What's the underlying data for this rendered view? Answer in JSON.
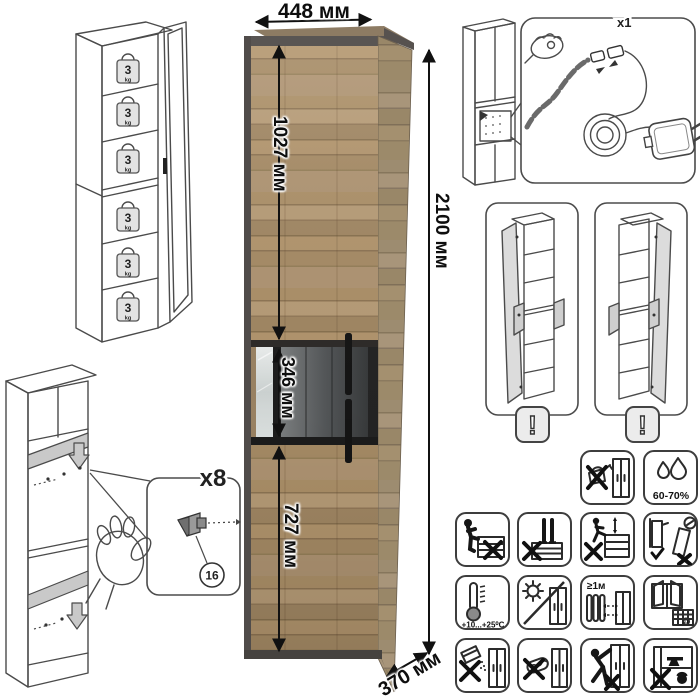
{
  "product": {
    "width_label": "448 мм",
    "height_label": "2100 мм",
    "depth_label": "370 мм",
    "upper_section_label": "1027 мм",
    "display_section_label": "346 мм",
    "lower_section_label": "727 мм"
  },
  "shelf_load": {
    "value": "3",
    "unit": "kg"
  },
  "assembly": {
    "shelf_pin_count": "x8",
    "shelf_pin_part": "16",
    "led_kit_count": "x1"
  },
  "variants": {
    "warning": "!"
  },
  "care": {
    "humidity": "60-70%",
    "temperature": "+10...+25⁰C",
    "heat_distance": "≥1м",
    "calendar_day": "21"
  },
  "colors": {
    "wood": "#a68a64",
    "wood_dark": "#8a7254",
    "frame": "#504c4a",
    "glass_dark": "#3a3b3c",
    "line_art": "#4b4b4b",
    "background": "#ffffff"
  }
}
